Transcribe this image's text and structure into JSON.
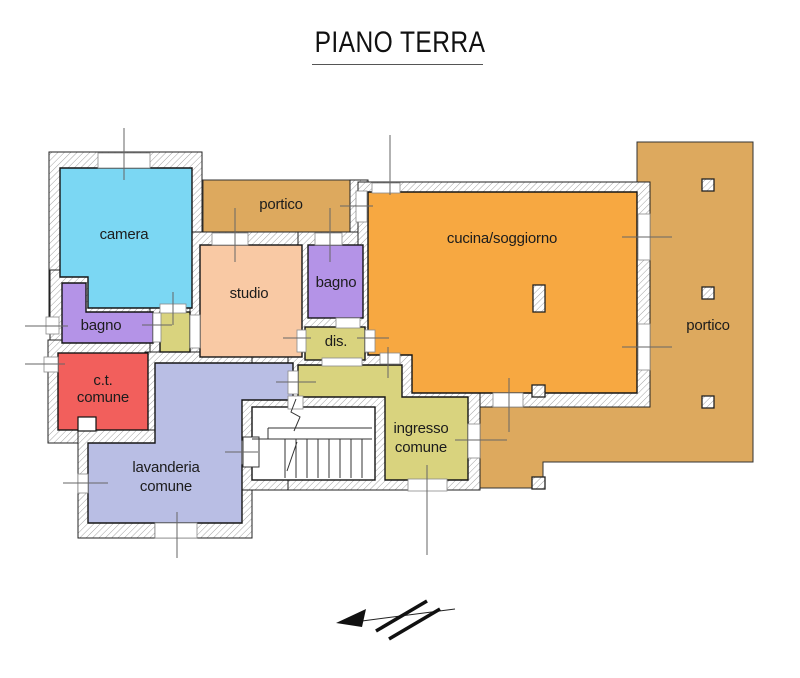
{
  "title": "PIANO TERRA",
  "labels": {
    "camera": "camera",
    "portico_top": "portico",
    "portico_right": "portico",
    "cucina": "cucina/soggiorno",
    "bagno_upper": "bagno",
    "bagno_lower": "bagno",
    "studio": "studio",
    "dis": "dis.",
    "ct_line1": "c.t.",
    "ct_line2": "comune",
    "lavanderia_line1": "lavanderia",
    "lavanderia_line2": "comune",
    "ingresso_line1": "ingresso",
    "ingresso_line2": "comune"
  },
  "colors": {
    "camera": "#7bd7f3",
    "bagno": "#b493e7",
    "studio": "#f9c9a4",
    "portico": "#dda95e",
    "cucina": "#f7a841",
    "service": "#d9d37e",
    "ct": "#f25f5c",
    "lavanderia": "#b9bee4"
  }
}
